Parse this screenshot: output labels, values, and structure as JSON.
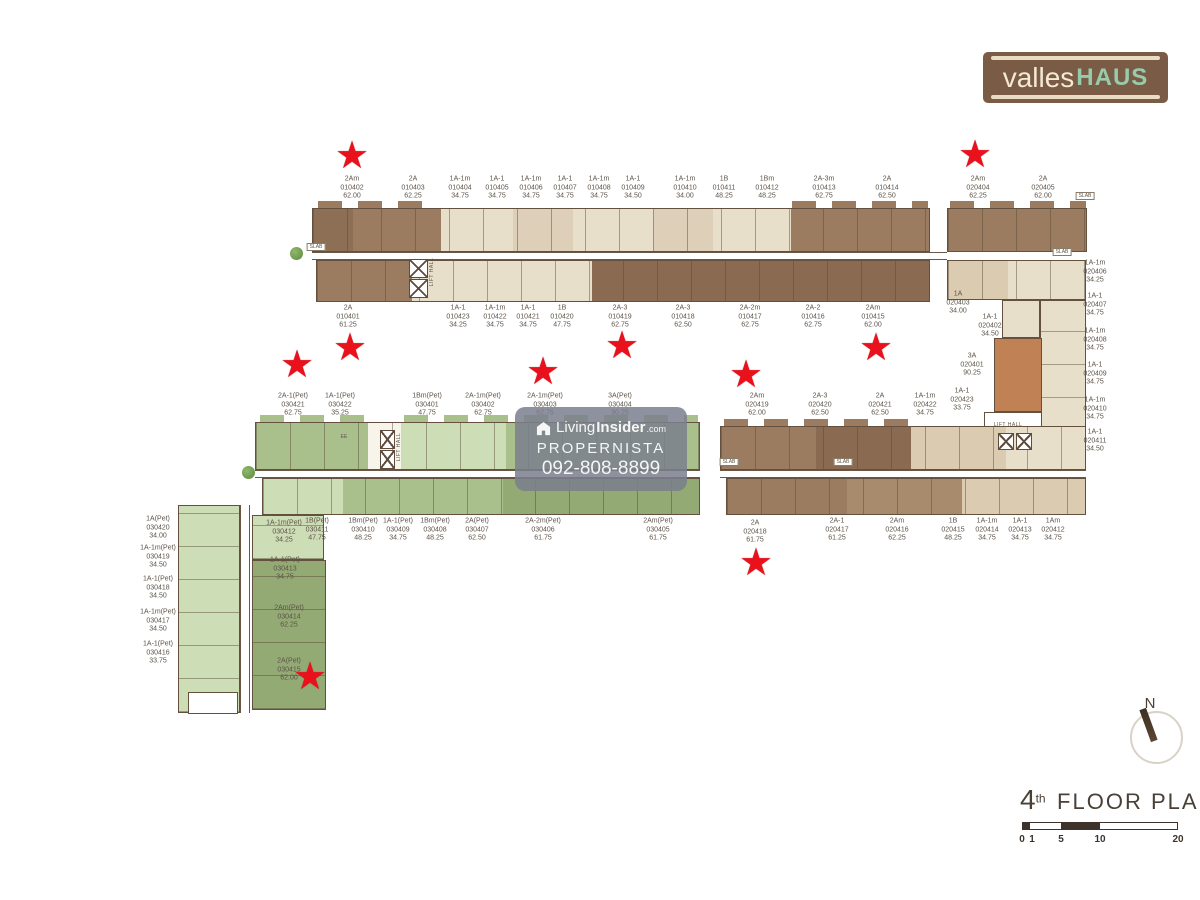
{
  "logo": {
    "part1": "valles",
    "part2": "HAUS"
  },
  "watermark": {
    "brand1": "Living",
    "brand2": "Insider",
    "brand3": ".com",
    "line2": "PROPERNISTA",
    "line3": "092-808-8899"
  },
  "title": {
    "num": "4",
    "sup": "th",
    "text": "FLOOR PLAN"
  },
  "scale_bar": {
    "ticks": [
      "0",
      "1",
      "5",
      "10",
      "20"
    ]
  },
  "compass": {
    "label": "N"
  },
  "plan_texts": {
    "lift_hall": "LIFT HALL",
    "slab": "SLAB",
    "ee": "EE",
    "lift_halls": [
      {
        "x": 432,
        "y": 272,
        "vert": true
      },
      {
        "x": 399,
        "y": 447,
        "vert": true
      },
      {
        "x": 1008,
        "y": 425,
        "vert": false
      }
    ],
    "slabs": [
      {
        "x": 316,
        "y": 247
      },
      {
        "x": 1085,
        "y": 196
      },
      {
        "x": 1062,
        "y": 252
      },
      {
        "x": 729,
        "y": 462
      },
      {
        "x": 843,
        "y": 462
      }
    ],
    "ees": [
      {
        "x": 344,
        "y": 437
      }
    ]
  },
  "markers": {
    "star_glyph": "★",
    "star_color": "#e8111c",
    "stars": [
      {
        "x": 352,
        "y": 156
      },
      {
        "x": 975,
        "y": 155
      },
      {
        "x": 297,
        "y": 365
      },
      {
        "x": 350,
        "y": 348
      },
      {
        "x": 543,
        "y": 372
      },
      {
        "x": 622,
        "y": 346
      },
      {
        "x": 746,
        "y": 375
      },
      {
        "x": 876,
        "y": 348
      },
      {
        "x": 756,
        "y": 563
      },
      {
        "x": 310,
        "y": 677
      }
    ]
  },
  "colors": {
    "brown": "#9b7c60",
    "brown_dark": "#8a6b51",
    "cream": "#e8dfca",
    "tan": "#ded0b8",
    "green_light": "#cdddb6",
    "green_mid": "#a9bf8c",
    "green_dark": "#93aa74",
    "orange": "#c08254",
    "star": "#e8111c",
    "logo_bg": "#7a5b45",
    "logo_mint": "#96cbab"
  },
  "units": [
    {
      "x": 352,
      "y": 188,
      "t": "2Am",
      "n": "010402",
      "a": "62.00"
    },
    {
      "x": 413,
      "y": 188,
      "t": "2A",
      "n": "010403",
      "a": "62.25"
    },
    {
      "x": 460,
      "y": 188,
      "t": "1A-1m",
      "n": "010404",
      "a": "34.75"
    },
    {
      "x": 497,
      "y": 188,
      "t": "1A-1",
      "n": "010405",
      "a": "34.75"
    },
    {
      "x": 531,
      "y": 188,
      "t": "1A-1m",
      "n": "010406",
      "a": "34.75"
    },
    {
      "x": 565,
      "y": 188,
      "t": "1A-1",
      "n": "010407",
      "a": "34.75"
    },
    {
      "x": 599,
      "y": 188,
      "t": "1A-1m",
      "n": "010408",
      "a": "34.75"
    },
    {
      "x": 633,
      "y": 188,
      "t": "1A-1",
      "n": "010409",
      "a": "34.50"
    },
    {
      "x": 685,
      "y": 188,
      "t": "1A-1m",
      "n": "010410",
      "a": "34.00"
    },
    {
      "x": 724,
      "y": 188,
      "t": "1B",
      "n": "010411",
      "a": "48.25"
    },
    {
      "x": 767,
      "y": 188,
      "t": "1Bm",
      "n": "010412",
      "a": "48.25"
    },
    {
      "x": 824,
      "y": 188,
      "t": "2A-3m",
      "n": "010413",
      "a": "62.75"
    },
    {
      "x": 887,
      "y": 188,
      "t": "2A",
      "n": "010414",
      "a": "62.50"
    },
    {
      "x": 978,
      "y": 188,
      "t": "2Am",
      "n": "020404",
      "a": "62.25"
    },
    {
      "x": 1043,
      "y": 188,
      "t": "2A",
      "n": "020405",
      "a": "62.00"
    },
    {
      "x": 348,
      "y": 317,
      "t": "2A",
      "n": "010401",
      "a": "61.25"
    },
    {
      "x": 458,
      "y": 317,
      "t": "1A-1",
      "n": "010423",
      "a": "34.25"
    },
    {
      "x": 495,
      "y": 317,
      "t": "1A-1m",
      "n": "010422",
      "a": "34.75"
    },
    {
      "x": 528,
      "y": 317,
      "t": "1A-1",
      "n": "010421",
      "a": "34.75"
    },
    {
      "x": 562,
      "y": 317,
      "t": "1B",
      "n": "010420",
      "a": "47.75"
    },
    {
      "x": 620,
      "y": 317,
      "t": "2A-3",
      "n": "010419",
      "a": "62.75"
    },
    {
      "x": 683,
      "y": 317,
      "t": "2A-3",
      "n": "010418",
      "a": "62.50"
    },
    {
      "x": 750,
      "y": 317,
      "t": "2A-2m",
      "n": "010417",
      "a": "62.75"
    },
    {
      "x": 813,
      "y": 317,
      "t": "2A-2",
      "n": "010416",
      "a": "62.75"
    },
    {
      "x": 873,
      "y": 317,
      "t": "2Am",
      "n": "010415",
      "a": "62.00"
    },
    {
      "x": 958,
      "y": 303,
      "t": "1A",
      "n": "020403",
      "a": "34.00"
    },
    {
      "x": 990,
      "y": 326,
      "t": "1A-1",
      "n": "020402",
      "a": "34.50"
    },
    {
      "x": 1095,
      "y": 272,
      "t": "1A-1m",
      "n": "020406",
      "a": "34.25"
    },
    {
      "x": 1095,
      "y": 305,
      "t": "1A-1",
      "n": "020407",
      "a": "34.75"
    },
    {
      "x": 1095,
      "y": 340,
      "t": "1A-1m",
      "n": "020408",
      "a": "34.75"
    },
    {
      "x": 1095,
      "y": 374,
      "t": "1A-1",
      "n": "020409",
      "a": "34.75"
    },
    {
      "x": 1095,
      "y": 409,
      "t": "1A-1m",
      "n": "020410",
      "a": "34.75"
    },
    {
      "x": 1095,
      "y": 441,
      "t": "1A-1",
      "n": "020411",
      "a": "34.50"
    },
    {
      "x": 972,
      "y": 365,
      "t": "3A",
      "n": "020401",
      "a": "90.25"
    },
    {
      "x": 293,
      "y": 405,
      "t": "2A-1(Pet)",
      "n": "030421",
      "a": "62.75"
    },
    {
      "x": 340,
      "y": 405,
      "t": "1A-1(Pet)",
      "n": "030422",
      "a": "35.25"
    },
    {
      "x": 427,
      "y": 405,
      "t": "1Bm(Pet)",
      "n": "030401",
      "a": "47.75"
    },
    {
      "x": 483,
      "y": 405,
      "t": "2A-1m(Pet)",
      "n": "030402",
      "a": "62.75"
    },
    {
      "x": 545,
      "y": 405,
      "t": "2A-1m(Pet)",
      "n": "030403",
      "a": "62.75"
    },
    {
      "x": 620,
      "y": 405,
      "t": "3A(Pet)",
      "n": "030404",
      "a": "90.25"
    },
    {
      "x": 757,
      "y": 405,
      "t": "2Am",
      "n": "020419",
      "a": "62.00"
    },
    {
      "x": 820,
      "y": 405,
      "t": "2A-3",
      "n": "020420",
      "a": "62.50"
    },
    {
      "x": 880,
      "y": 405,
      "t": "2A",
      "n": "020421",
      "a": "62.50"
    },
    {
      "x": 925,
      "y": 405,
      "t": "1A-1m",
      "n": "020422",
      "a": "34.75"
    },
    {
      "x": 962,
      "y": 400,
      "t": "1A-1",
      "n": "020423",
      "a": "33.75"
    },
    {
      "x": 317,
      "y": 530,
      "t": "1B(Pet)",
      "n": "030411",
      "a": "47.75"
    },
    {
      "x": 363,
      "y": 530,
      "t": "1Bm(Pet)",
      "n": "030410",
      "a": "48.25"
    },
    {
      "x": 398,
      "y": 530,
      "t": "1A-1(Pet)",
      "n": "030409",
      "a": "34.75"
    },
    {
      "x": 435,
      "y": 530,
      "t": "1Bm(Pet)",
      "n": "030408",
      "a": "48.25"
    },
    {
      "x": 477,
      "y": 530,
      "t": "2A(Pet)",
      "n": "030407",
      "a": "62.50"
    },
    {
      "x": 543,
      "y": 530,
      "t": "2A-2m(Pet)",
      "n": "030406",
      "a": "61.75"
    },
    {
      "x": 658,
      "y": 530,
      "t": "2Am(Pet)",
      "n": "030405",
      "a": "61.75"
    },
    {
      "x": 755,
      "y": 532,
      "t": "2A",
      "n": "020418",
      "a": "61.75"
    },
    {
      "x": 837,
      "y": 530,
      "t": "2A-1",
      "n": "020417",
      "a": "61.25"
    },
    {
      "x": 897,
      "y": 530,
      "t": "2Am",
      "n": "020416",
      "a": "62.25"
    },
    {
      "x": 953,
      "y": 530,
      "t": "1B",
      "n": "020415",
      "a": "48.25"
    },
    {
      "x": 987,
      "y": 530,
      "t": "1A-1m",
      "n": "020414",
      "a": "34.75"
    },
    {
      "x": 1020,
      "y": 530,
      "t": "1A-1",
      "n": "020413",
      "a": "34.75"
    },
    {
      "x": 1053,
      "y": 530,
      "t": "1Am",
      "n": "020412",
      "a": "34.75"
    },
    {
      "x": 158,
      "y": 528,
      "t": "1A(Pet)",
      "n": "030420",
      "a": "34.00"
    },
    {
      "x": 158,
      "y": 557,
      "t": "1A-1m(Pet)",
      "n": "030419",
      "a": "34.50"
    },
    {
      "x": 158,
      "y": 588,
      "t": "1A-1(Pet)",
      "n": "030418",
      "a": "34.50"
    },
    {
      "x": 158,
      "y": 621,
      "t": "1A-1m(Pet)",
      "n": "030417",
      "a": "34.50"
    },
    {
      "x": 158,
      "y": 653,
      "t": "1A-1(Pet)",
      "n": "030416",
      "a": "33.75"
    },
    {
      "x": 284,
      "y": 532,
      "t": "1A-1m(Pet)",
      "n": "030412",
      "a": "34.25"
    },
    {
      "x": 285,
      "y": 569,
      "t": "1A-1(Pet)",
      "n": "030413",
      "a": "34.75"
    },
    {
      "x": 289,
      "y": 617,
      "t": "2Am(Pet)",
      "n": "030414",
      "a": "62.25"
    },
    {
      "x": 289,
      "y": 670,
      "t": "2A(Pet)",
      "n": "030415",
      "a": "62.00"
    }
  ]
}
